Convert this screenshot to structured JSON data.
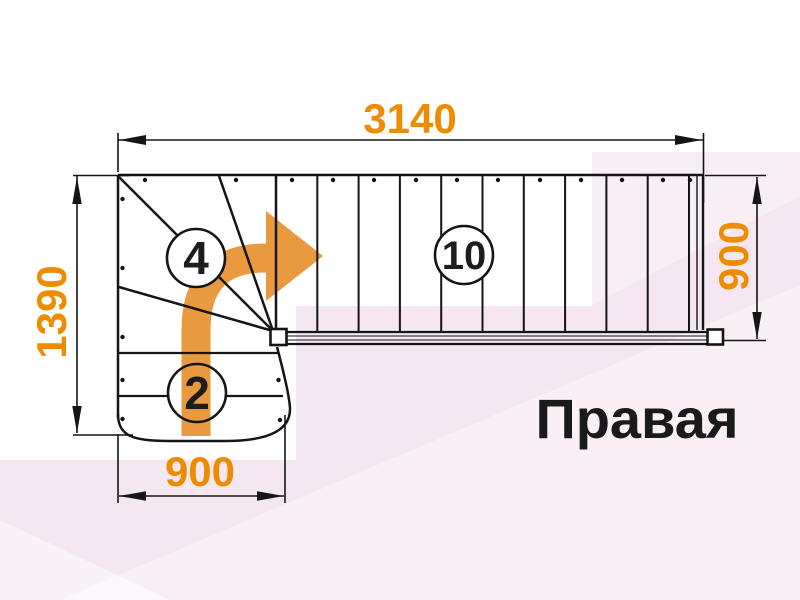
{
  "drawing": {
    "orientation_label": "Правая",
    "dimensions": {
      "top_width": "3140",
      "left_height": "1390",
      "right_height": "900",
      "bottom_width": "900"
    },
    "step_counts": {
      "winder_steps": "4",
      "straight_steps": "10",
      "lower_steps": "2"
    }
  },
  "colors": {
    "dimension_text": "#EE8C00",
    "direction_arrow": "#E9993E",
    "drawing_line": "#151515",
    "label_text": "#1a1a1a",
    "background_accent_pink": "#F5E7F1"
  }
}
